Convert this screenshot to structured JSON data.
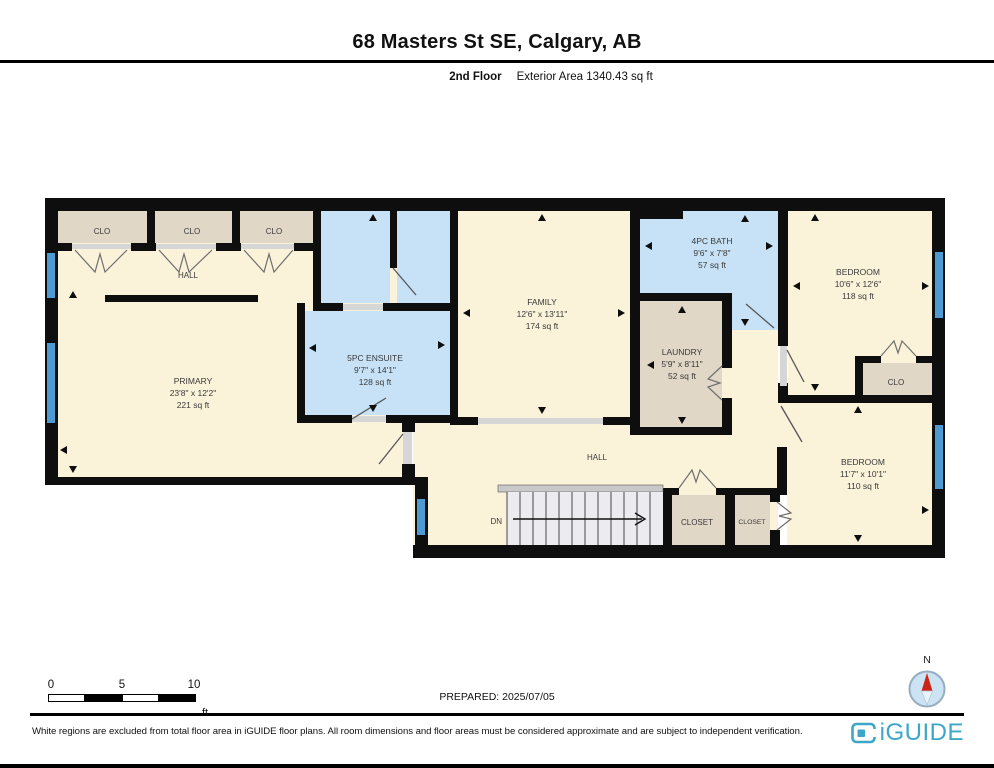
{
  "header": {
    "title": "68 Masters St SE, Calgary, AB",
    "floor_label": "2nd Floor",
    "area_label": "Exterior Area 1340.43 sq ft"
  },
  "rooms": {
    "primary": {
      "name": "PRIMARY",
      "dims": "23'8\" x 12'2\"",
      "area": "221 sq ft"
    },
    "ensuite": {
      "name": "5PC ENSUITE",
      "dims": "9'7\" x 14'1\"",
      "area": "128 sq ft"
    },
    "family": {
      "name": "FAMILY",
      "dims": "12'6\" x 13'11\"",
      "area": "174 sq ft"
    },
    "bath": {
      "name": "4PC BATH",
      "dims": "9'6\" x 7'8\"",
      "area": "57 sq ft"
    },
    "laundry": {
      "name": "LAUNDRY",
      "dims": "5'9\" x 8'11\"",
      "area": "52 sq ft"
    },
    "bedroom1": {
      "name": "BEDROOM",
      "dims": "10'6\" x 12'6\"",
      "area": "118 sq ft"
    },
    "bedroom2": {
      "name": "BEDROOM",
      "dims": "11'7\" x 10'1\"",
      "area": "110 sq ft"
    },
    "closet1_top": "CLO",
    "closet2_top": "CLO",
    "closet3_top": "CLO",
    "bedroom_clo": "CLO",
    "hall_upper": "HALL",
    "hall_lower": "HALL",
    "hall_closet": "CLOSET",
    "bedroom2_closet": "CLOSET",
    "stairs_label": "DN"
  },
  "scale_bar": {
    "tick0": "0",
    "tick5": "5",
    "tick10": "10",
    "unit": "ft"
  },
  "prepared_label": "PREPARED: 2025/07/05",
  "compass": {
    "north_label": "N"
  },
  "footer": {
    "disclaimer": "White regions are excluded from total floor area in iGUIDE floor plans. All room dimensions and floor areas must be considered approximate and are subject to independent verification.",
    "brand": "iGUIDE"
  },
  "colors": {
    "room_cream": "#FAF2D9",
    "closet_tan": "#E0D7C7",
    "wet_room_blue": "#C7E2F7",
    "window_blue": "#4E9BD4",
    "wall_black": "#0E0E0E",
    "brand_teal": "#3EA6C6",
    "compass_red": "#CC2318"
  }
}
